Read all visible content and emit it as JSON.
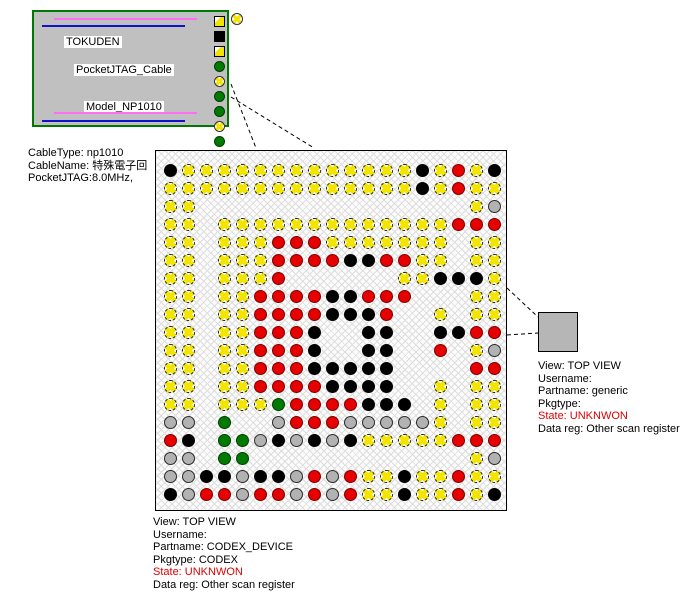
{
  "cable_box": {
    "vendor": "TOKUDEN",
    "product": "PocketJTAG_Cable",
    "model": "Model_NP1010",
    "legend_icons": [
      "yellow-square",
      "black-square",
      "yellow-square",
      "green-circle",
      "yellow-circle",
      "green-circle",
      "green-circle",
      "yellow-circle",
      "green-circle"
    ]
  },
  "cable_info": {
    "line1": "CableType: np1010",
    "line2": "CableName: 特殊電子回",
    "line3": "PocketJTAG:8.0MHz,"
  },
  "device_info": {
    "view": "View: TOP VIEW",
    "username": "Username:",
    "partname": "Partname: CODEX_DEVICE",
    "pkgtype": "Pkgtype: CODEX",
    "state": "State: UNKNWON",
    "datareg": "Data reg: Other scan register"
  },
  "remote_info": {
    "view": "View: TOP VIEW",
    "username": "Username:",
    "partname": "Partname: generic",
    "pkgtype": "Pkgtype:",
    "state": "State: UNKNWON",
    "datareg": "Data reg: Other scan register"
  },
  "grid": {
    "cols": 19,
    "rows": 19,
    "pin_pitch_px": 18,
    "pin_codes": {
      "Y": "yellow-open-pin",
      "R": "red-pin",
      "B": "black-pin",
      "E": "gray-pin",
      "G": "green-pin",
      ".": "empty"
    },
    "matrix": [
      "BYYYYYYYYYYYYYBYRYB",
      "YYYYYYYYYYYYYYBYRYY",
      "YY...............YE",
      "YY.YYYYYYYYYYYYYRRR",
      "YY.YYYRRRYYYYYYY.YY",
      "YY.YYYRRRRBBRRYY.YY",
      "YY.YYYR......YYBBBY",
      "YY.YYRRRRBBRRR...YY",
      "YY.YYRRRRBBBR..Y.YY",
      "YY.YYRRRB..BB..BBRR",
      "YY.YYRRRB..BB..R.YE",
      "YY.YYRRRBBBBB....RR",
      "YY.YYRRRRBBBB..Y.YY",
      "YY.YYYGRRRRBBB.Y.YY",
      "EE.G..ERRREEEEEY.YY",
      "RB.GGEBEBEBYYYYYRRR",
      "EE.GG............YE",
      "EEBBEBBERERYYBYYRYY",
      "BERRERRERERYYBYYRYB"
    ]
  },
  "colors": {
    "pin_yellow_cross": "#f3e500",
    "pin_red": "#e60000",
    "pin_black": "#000000",
    "pin_gray": "#b2b2b2",
    "pin_green": "#007a00",
    "state_text": "#e00000",
    "cable_border": "#007700",
    "cable_fill": "#c0c0c0",
    "stripe_pink": "#ff6ef2",
    "stripe_blue": "#1111cc"
  }
}
